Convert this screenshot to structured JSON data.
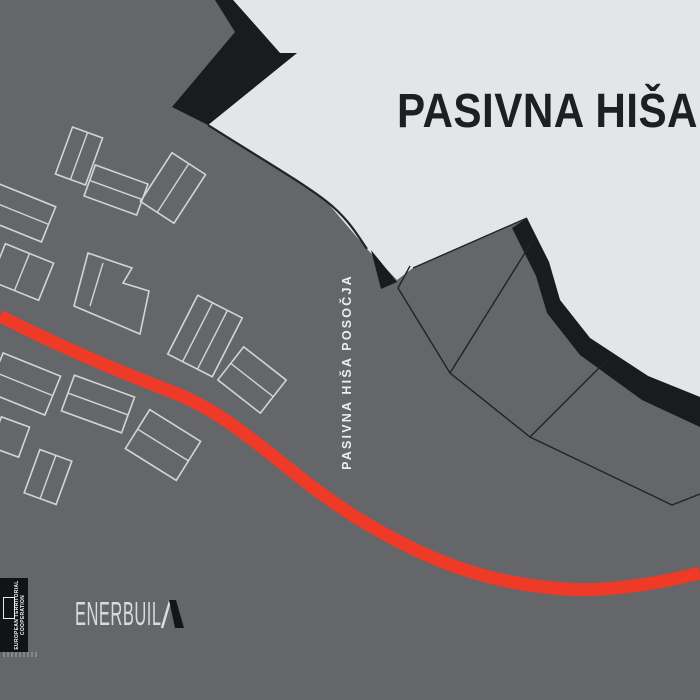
{
  "poster": {
    "title": "PASIVNA HIŠA",
    "side_label": "PASIVNA HIŠA POSOČJA",
    "partner_logo_text": "ENERBUIL",
    "partner_logo_glyph": "stylized-black-D-slash",
    "eu_badge": {
      "line1": "EUROPEAN TERRITORIAL",
      "line2": "COOPERATION"
    }
  },
  "colors": {
    "field": "#646669",
    "light": "#e4e5e7",
    "ink": "#1a1b1d",
    "badge": "#121316",
    "line": "#222326",
    "road": "#ee3a27",
    "building_outline": "#d3d4d6",
    "title_ink": "#1d1f23",
    "light_text": "#eceded",
    "logo_text": "#d9dadc"
  },
  "map": {
    "light_region": "233,0 700,0 700,397 648,376 590,338 560,300 549,262 527,218 413,268 397,280 367,249 326,201 300,182 250,152 208,125 297,53 280,53",
    "mountain_chevron": "215,0 233,0 280,53 297,53 208,125 172,107 235,32",
    "slope_wedge": "371,250 397,282 381,289",
    "edge_band": "527,218 549,262 560,300 590,338 648,376 700,397 700,427 642,400 580,355 547,313 536,276 512,228",
    "terrain_edge": "M208,125 C255,155 300,181 326,201 C348,218 358,236 367,249",
    "parcel_lines": [
      "M413,268 L527,218",
      "M410,266 L398,288 L450,373 L530,437 L672,505 L700,494",
      "M533,240 L450,373",
      "M607,360 L530,437"
    ],
    "road": "M0,316 C55,344 115,370 170,391 C220,410 255,442 297,475 C339,508 370,528 420,552 C465,573 510,585 565,589 C610,592 660,583 700,573",
    "road_width": 13,
    "buildings": [
      {
        "cx": 79,
        "cy": 156,
        "w": 32,
        "h": 50,
        "rot": 20,
        "parts": 2,
        "div": "cols"
      },
      {
        "cx": 116,
        "cy": 190,
        "w": 56,
        "h": 33,
        "rot": 20,
        "parts": 2,
        "div": "bands"
      },
      {
        "cx": 173,
        "cy": 188,
        "w": 40,
        "h": 58,
        "rot": 33,
        "parts": 2,
        "div": "cols"
      },
      {
        "cx": 18,
        "cy": 212,
        "w": 66,
        "h": 38,
        "rot": 22,
        "parts": 2,
        "div": "bands"
      },
      {
        "cx": 22,
        "cy": 272,
        "w": 52,
        "h": 40,
        "rot": 22,
        "parts": 2,
        "div": "cols"
      },
      {
        "cx": 205,
        "cy": 336,
        "w": 50,
        "h": 66,
        "rot": 27,
        "parts": 3,
        "div": "cols"
      },
      {
        "cx": 252,
        "cy": 380,
        "w": 54,
        "h": 42,
        "rot": 38,
        "parts": 2,
        "div": "bands"
      },
      {
        "cx": 24,
        "cy": 384,
        "w": 62,
        "h": 42,
        "rot": 22,
        "parts": 2,
        "div": "bands"
      },
      {
        "cx": 98,
        "cy": 404,
        "w": 64,
        "h": 38,
        "rot": 20,
        "parts": 2,
        "div": "bands"
      },
      {
        "cx": 163,
        "cy": 445,
        "w": 60,
        "h": 46,
        "rot": 32,
        "parts": 2,
        "div": "bands"
      },
      {
        "cx": 48,
        "cy": 477,
        "w": 34,
        "h": 46,
        "rot": 20,
        "parts": 2,
        "div": "cols"
      },
      {
        "cx": 10,
        "cy": 437,
        "w": 30,
        "h": 32,
        "rot": 20,
        "parts": 1,
        "div": "bands"
      }
    ],
    "l_building": {
      "points": "88,253 132,268 123,283 149,291 140,334 74,306",
      "divider": "M103,263 L90,306"
    }
  }
}
